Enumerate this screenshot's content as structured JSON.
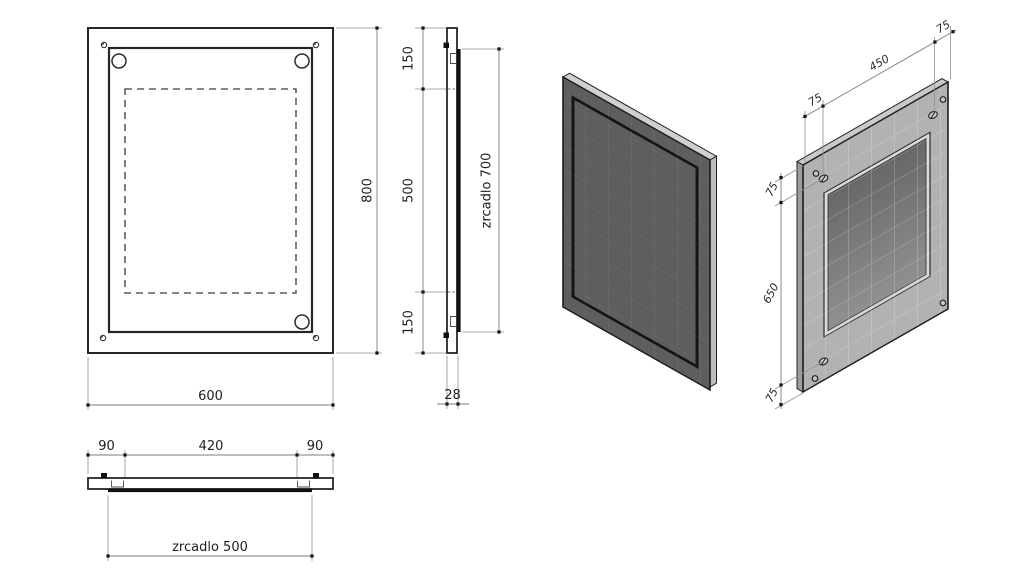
{
  "drawing": {
    "front": {
      "dim_width": "600",
      "dim_height": "800"
    },
    "side": {
      "dim_top": "150",
      "dim_middle": "500",
      "dim_bottom": "150",
      "dim_mirror": "zrcadlo 700",
      "dim_thickness": "28"
    },
    "bottom": {
      "dim_left": "90",
      "dim_center": "420",
      "dim_right": "90",
      "dim_mirror": "zrcadlo 500"
    },
    "iso_back": {
      "dim_top_left": "75",
      "dim_top_center": "450",
      "dim_top_right": "75",
      "dim_side_top": "75",
      "dim_side_middle": "650",
      "dim_side_bottom": "75"
    }
  },
  "colors": {
    "outline": "#262626",
    "dimension_line": "#7d7d7d",
    "iso_front_face": "#5e5e5e",
    "iso_front_edge_top": "#d0d0d0",
    "iso_front_edge_right": "#bdbdbd",
    "iso_back_face": "#b2b2b2",
    "iso_back_edge_top": "#c9c9c9",
    "iso_back_edge_left": "#9d9d9d",
    "recess_rim": "#d8d8d8",
    "recess_dark": "#696969",
    "recess_light": "#8f8f8f",
    "mirror_glass": "#111111"
  }
}
